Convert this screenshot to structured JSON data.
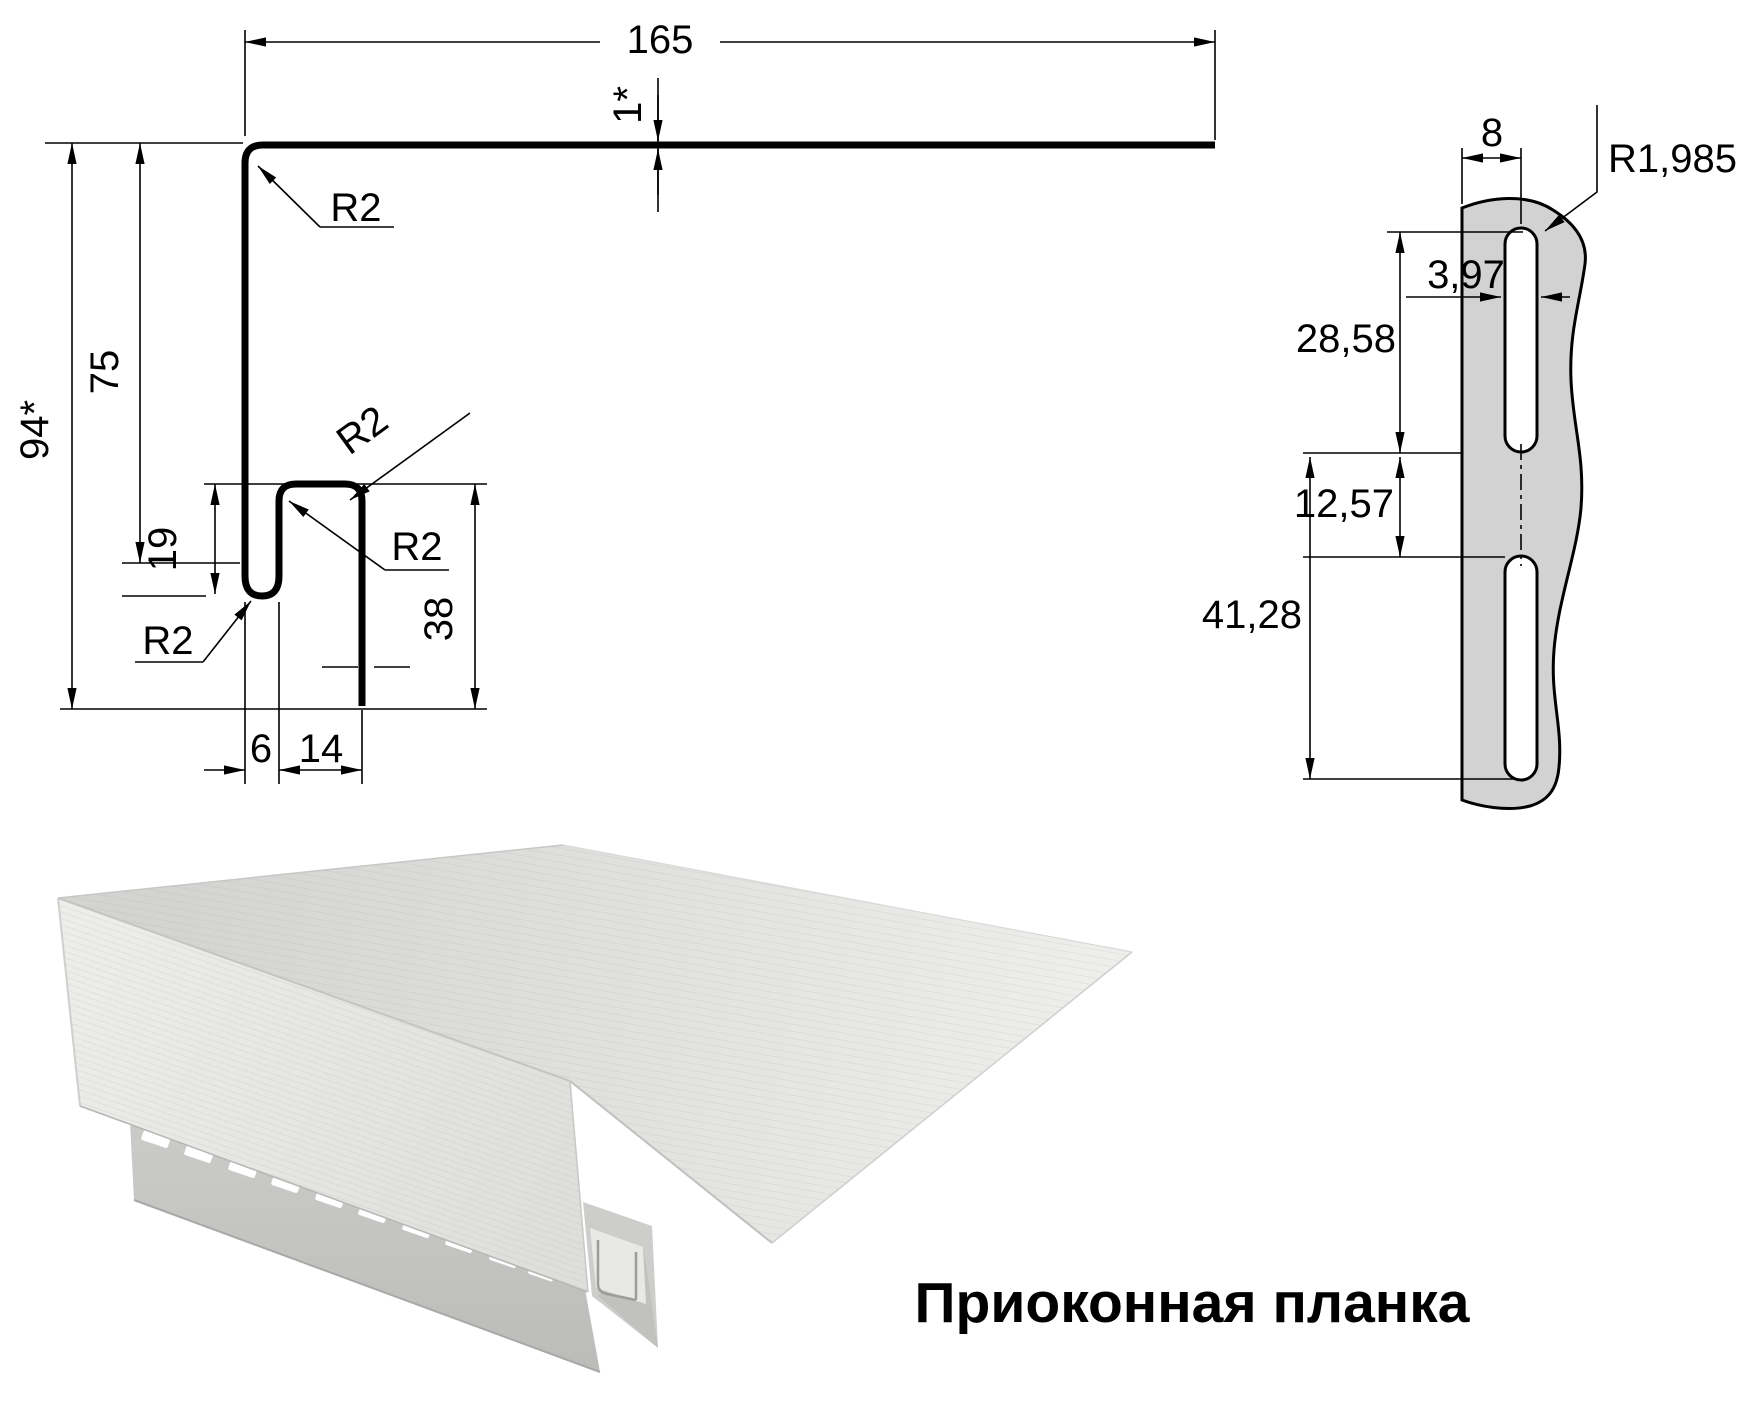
{
  "title": "Приоконная планка",
  "profile": {
    "width": "165",
    "thickness": "1*",
    "total_height": "94*",
    "leg_height": "75",
    "hook_depth": "19",
    "step_height": "38",
    "bottom_gap": "6",
    "bottom_width": "14",
    "radius_top": "R2",
    "radius_step_outer": "R2",
    "radius_step_inner": "R2",
    "radius_hook": "R2"
  },
  "detail": {
    "hem_offset": "8",
    "slot_radius": "R1,985",
    "slot_width": "3,97",
    "slot_length": "28,58",
    "slot_gap": "12,57",
    "slot_pitch": "41,28"
  },
  "colors": {
    "line": "#000000",
    "detail_fill": "#d2d2d2",
    "render_top_dark": "#d2d2d0",
    "render_top_light": "#eeeeec",
    "render_front": "#e9e9e7",
    "render_hem": "#c6c6c4"
  }
}
